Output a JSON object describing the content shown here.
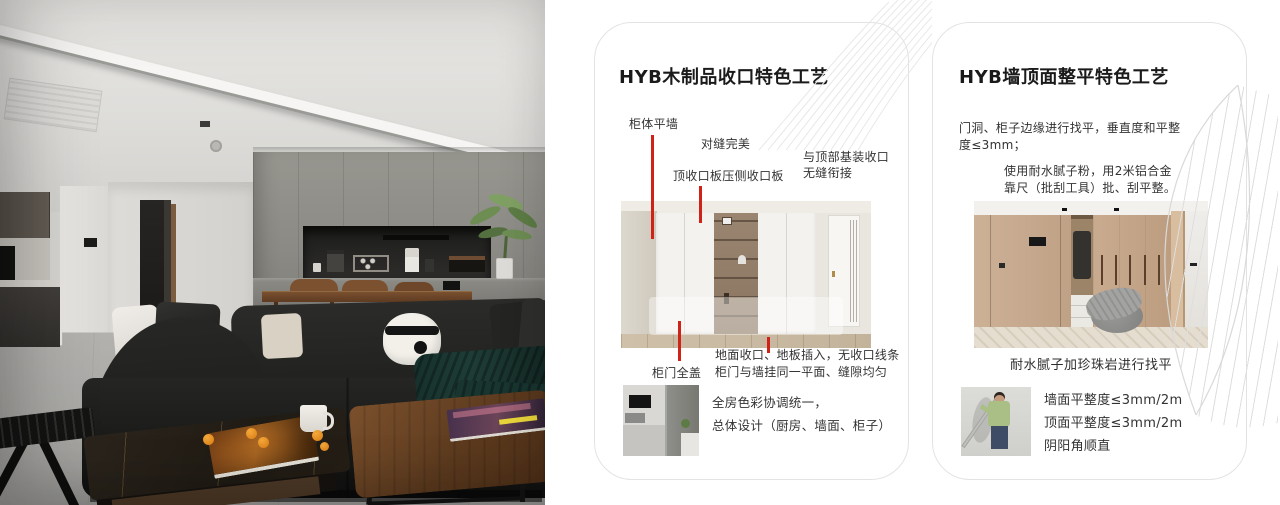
{
  "colors": {
    "page_bg": "#ffffff",
    "accent_red": "#cf2317",
    "card_border": "#e3e3e3",
    "sofa_black": "#1a1a19",
    "wall_grey": "#8f8f8b",
    "wood_brown": "#6e4b2e"
  },
  "card1": {
    "title": "HYB木制品收口特色工艺",
    "callouts": {
      "c1": "柜体平墙",
      "c2": "对缝完美",
      "c3": "顶收口板压侧收口板",
      "c4_line1": "与顶部基装收口",
      "c4_line2": "无缝衔接",
      "c5": "柜门全盖",
      "c6_line1": "地面收口、地板插入，无收口线条",
      "c6_line2": "柜门与墙挂同一平面、缝隙均匀"
    },
    "footer_line1": "全房色彩协调统一，",
    "footer_line2": "总体设计（厨房、墙面、柜子）"
  },
  "card2": {
    "title": "HYB墙顶面整平特色工艺",
    "para1_line1": "门洞、柜子边缘进行找平，垂直度和平整",
    "para1_line2": "度≤3mm；",
    "para2_line1": "使用耐水腻子粉，用2米铝合金",
    "para2_line2": "靠尺（批刮工具）批、刮平整。",
    "caption": "耐水腻子加珍珠岩进行找平",
    "spec1": "墙面平整度≤3mm/2m",
    "spec2": "顶面平整度≤3mm/2m",
    "spec3": "阴阳角顺直"
  }
}
